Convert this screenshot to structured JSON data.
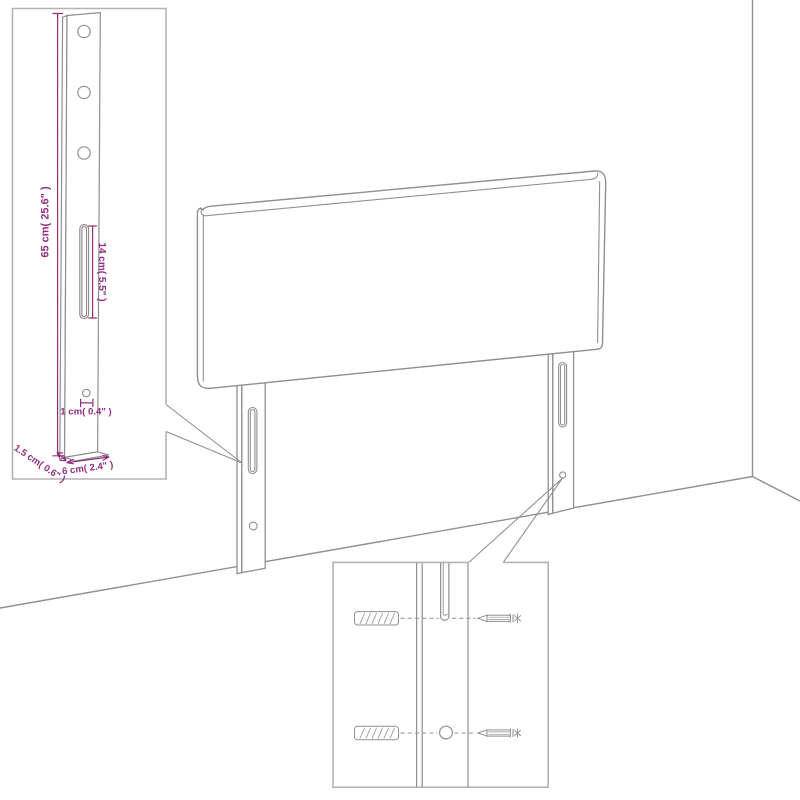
{
  "annotations": {
    "post_height": "65 cm( 25.6\" )",
    "slot_length": "14 cm( 5.5\" )",
    "hole_size": "1 cm( 0.4\" )",
    "post_depth": "1.5 cm( 0.6\" )",
    "post_width": "6 cm( 2.4\" )"
  },
  "colors": {
    "line": "#8f8f8f",
    "annotation": "#952d80",
    "inset_border": "#b3b3b3",
    "background": "#ffffff"
  }
}
